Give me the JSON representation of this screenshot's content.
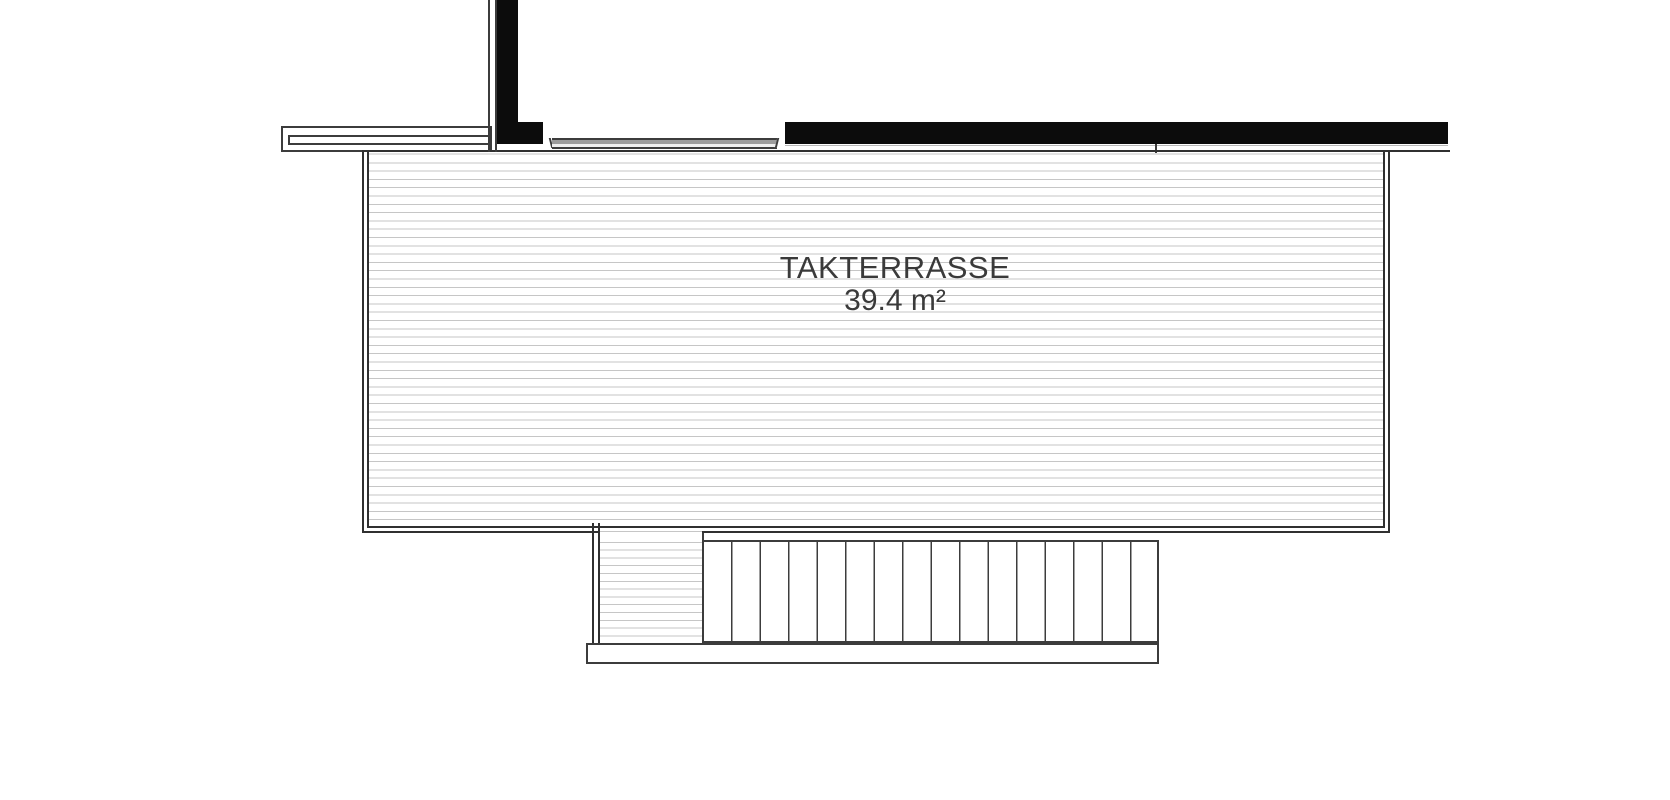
{
  "room": {
    "name": "TAKTERRASSE",
    "area": "39.4 m²"
  },
  "colors": {
    "background": "#ffffff",
    "wall_fill": "#0c0c0c",
    "outline_dark": "#303030",
    "outline_soft": "#3c3c3c",
    "hatch_line": "#c6c6c6",
    "glazing_fill": "#9c9c9c",
    "label_text": "#3a3a3a"
  }
}
